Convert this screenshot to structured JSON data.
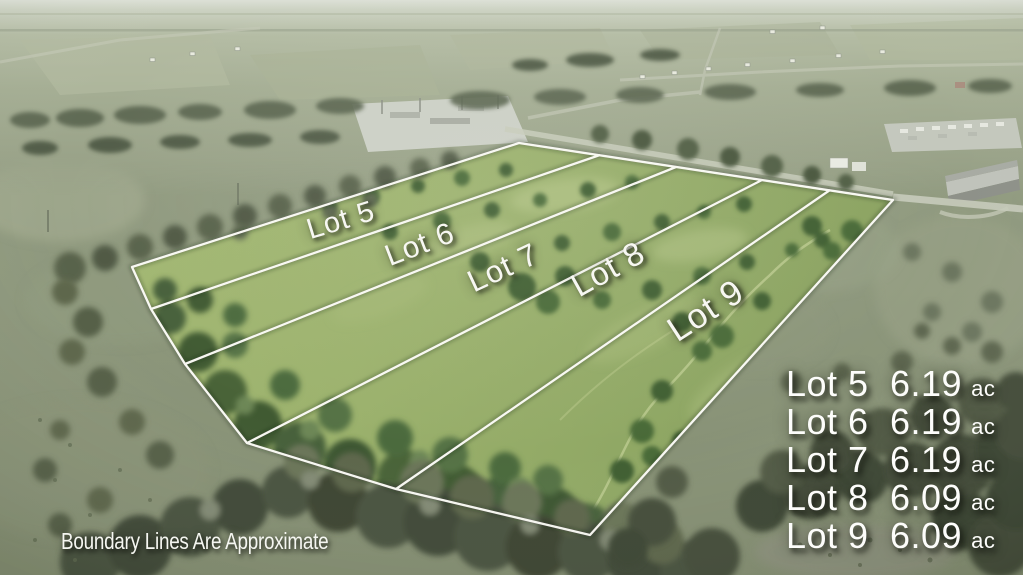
{
  "lots": [
    {
      "label": "Lot 5"
    },
    {
      "label": "Lot 6"
    },
    {
      "label": "Lot 7"
    },
    {
      "label": "Lot 8"
    },
    {
      "label": "Lot 9"
    }
  ],
  "legend": {
    "items": [
      {
        "lot": "Lot 5",
        "acreage": "6.19",
        "unit": "ac"
      },
      {
        "lot": "Lot 6",
        "acreage": "6.19",
        "unit": "ac"
      },
      {
        "lot": "Lot 7",
        "acreage": "6.19",
        "unit": "ac"
      },
      {
        "lot": "Lot 8",
        "acreage": "6.09",
        "unit": "ac"
      },
      {
        "lot": "Lot 9",
        "acreage": "6.09",
        "unit": "ac"
      }
    ]
  },
  "disclaimer": "Boundary Lines Are Approximate",
  "colors": {
    "boundary_line": "#fdfdf8",
    "overlay_text": "#f7f7f2",
    "lot_field_green": "#9db36f",
    "forest_green": "#3f5a33",
    "muted_pasture": "#8e977e"
  }
}
